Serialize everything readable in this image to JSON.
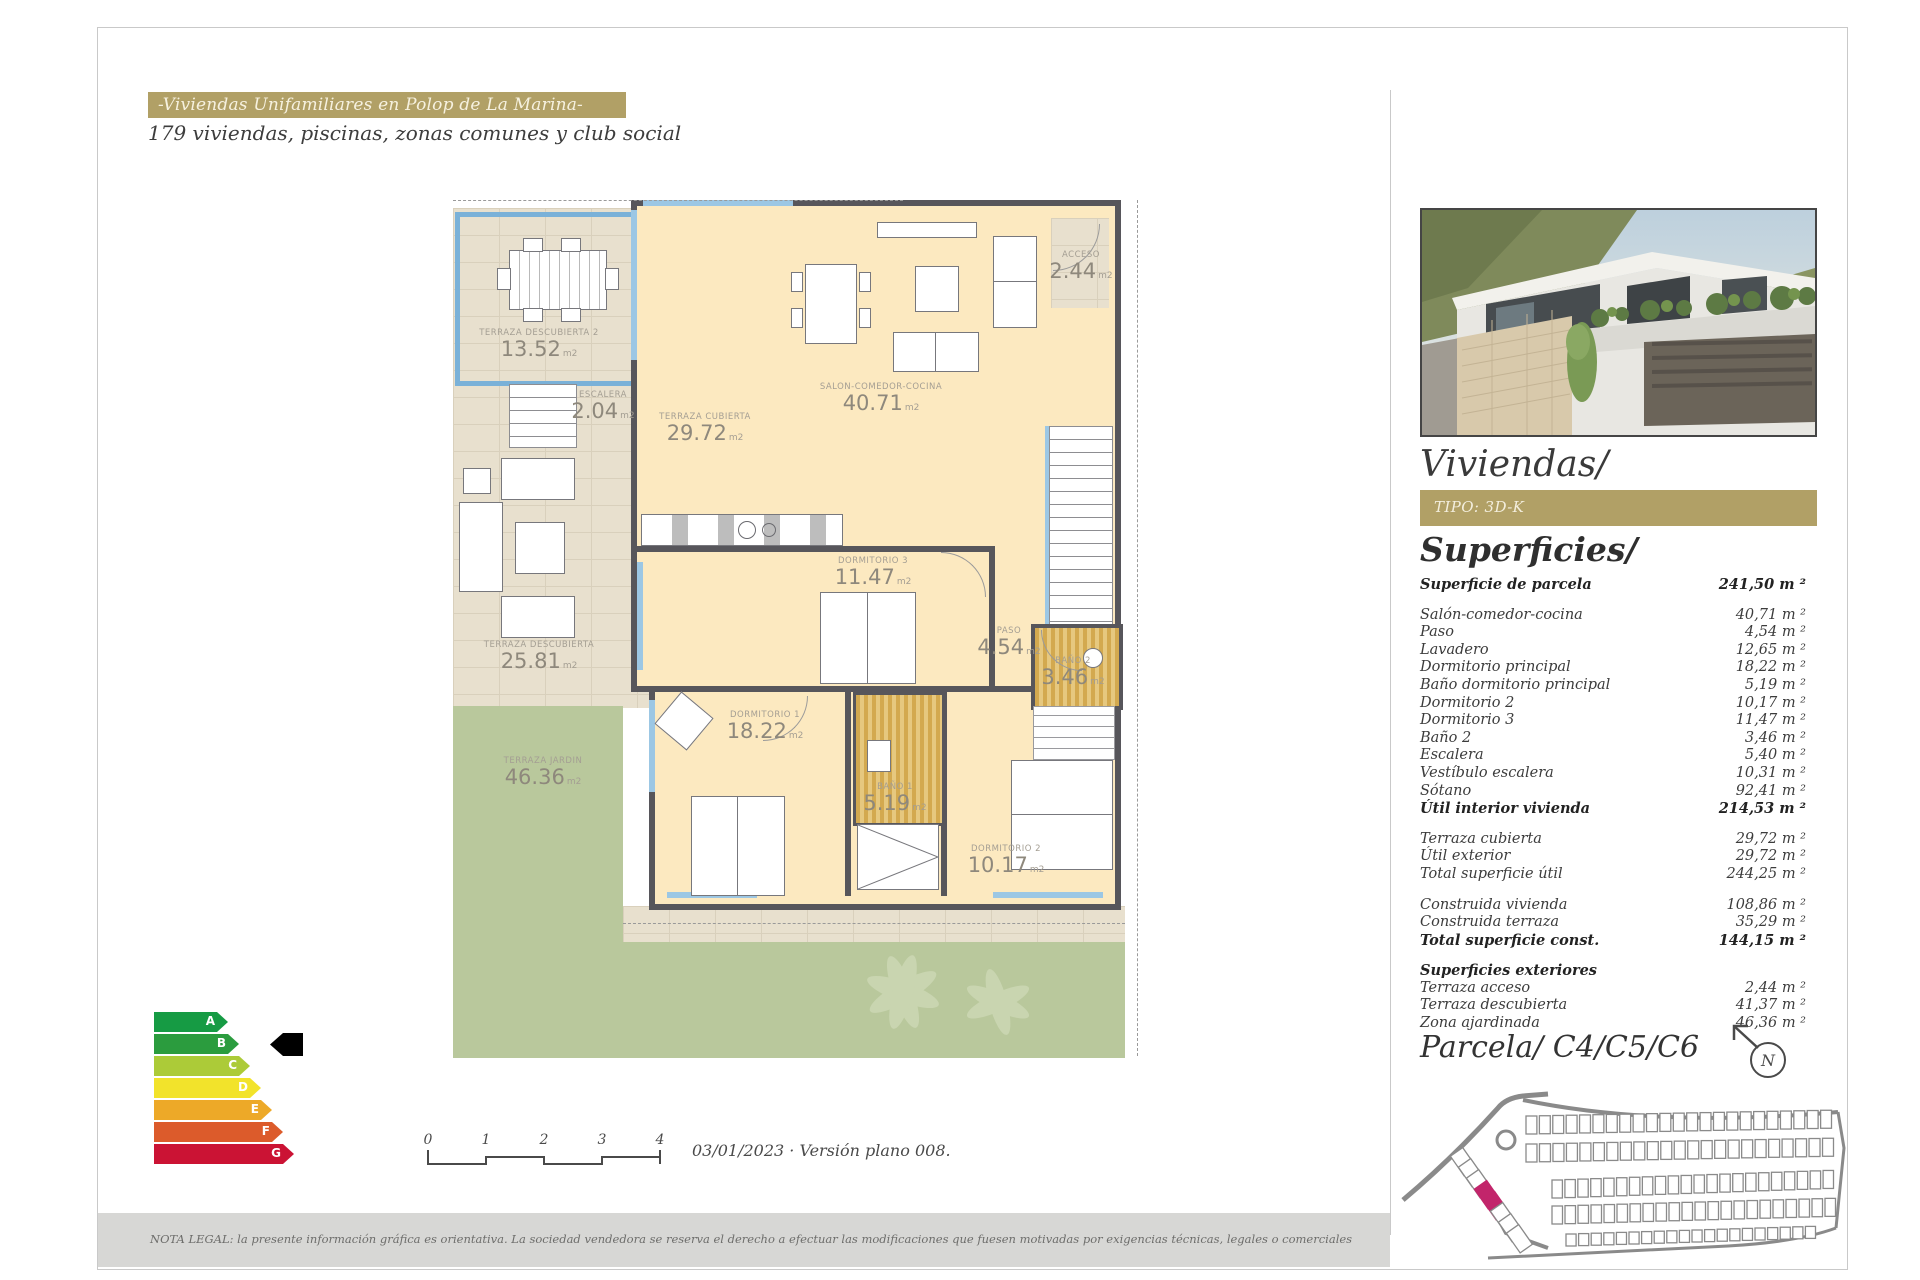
{
  "header": {
    "title": "-Viviendas Unifamiliares en Polop de La Marina-",
    "subtitle": "179 viviendas, piscinas, zonas comunes y club social"
  },
  "sidebar": {
    "viviendas_heading": "Viviendas/",
    "tipo_label": "TIPO: 3D-K",
    "superficies_heading": "Superficies/",
    "parcela_heading": "Parcela/ C4/C5/C6",
    "compass_letter": "N",
    "superficies": {
      "groups": [
        [
          {
            "label": "Superficie de parcela",
            "value": "241,50 m ²",
            "bold": true
          }
        ],
        [
          {
            "label": "Salón-comedor-cocina",
            "value": "40,71 m ²",
            "bold": false
          },
          {
            "label": "Paso",
            "value": "4,54 m ²",
            "bold": false
          },
          {
            "label": "Lavadero",
            "value": "12,65 m ²",
            "bold": false
          },
          {
            "label": "Dormitorio principal",
            "value": "18,22 m ²",
            "bold": false
          },
          {
            "label": "Baño dormitorio principal",
            "value": "5,19 m ²",
            "bold": false
          },
          {
            "label": "Dormitorio 2",
            "value": "10,17 m ²",
            "bold": false
          },
          {
            "label": "Dormitorio 3",
            "value": "11,47 m ²",
            "bold": false
          },
          {
            "label": "Baño 2",
            "value": "3,46 m ²",
            "bold": false
          },
          {
            "label": "Escalera",
            "value": "5,40 m ²",
            "bold": false
          },
          {
            "label": "Vestíbulo escalera",
            "value": "10,31 m ²",
            "bold": false
          },
          {
            "label": "Sótano",
            "value": "92,41 m ²",
            "bold": false
          },
          {
            "label": "Útil interior vivienda",
            "value": "214,53 m ²",
            "bold": true
          }
        ],
        [
          {
            "label": "Terraza cubierta",
            "value": "29,72 m ²",
            "bold": false
          },
          {
            "label": "Útil exterior",
            "value": "29,72 m ²",
            "bold": false
          },
          {
            "label": "Total superficie útil",
            "value": "244,25 m ²",
            "bold": false
          }
        ],
        [
          {
            "label": "Construida vivienda",
            "value": "108,86 m ²",
            "bold": false
          },
          {
            "label": "Construida terraza",
            "value": "35,29 m ²",
            "bold": false
          },
          {
            "label": "Total superficie const.",
            "value": "144,15 m ²",
            "bold": true
          }
        ],
        [
          {
            "label": "Superficies exteriores",
            "value": "",
            "bold": true
          },
          {
            "label": "Terraza acceso",
            "value": "2,44 m ²",
            "bold": false
          },
          {
            "label": "Terraza descubierta",
            "value": "41,37 m ²",
            "bold": false
          },
          {
            "label": "Zona ajardinada",
            "value": "46,36 m ²",
            "bold": false
          }
        ]
      ]
    }
  },
  "floorplan": {
    "unit": "m2",
    "rooms": [
      {
        "name": "TERRAZA DESCUBIERTA 2",
        "area": "13.52",
        "unit": "m2"
      },
      {
        "name": "ESCALERA",
        "area": "2.04",
        "unit": "m2"
      },
      {
        "name": "TERRAZA CUBIERTA",
        "area": "29.72",
        "unit": "m2"
      },
      {
        "name": "SALON-COMEDOR-COCINA",
        "area": "40.71",
        "unit": "m2"
      },
      {
        "name": "ACCESO",
        "area": "2.44",
        "unit": "m2"
      },
      {
        "name": "DORMITORIO 3",
        "area": "11.47",
        "unit": "m2"
      },
      {
        "name": "PASO",
        "area": "4.54",
        "unit": "m2"
      },
      {
        "name": "BAÑO 2",
        "area": "3.46",
        "unit": "m2"
      },
      {
        "name": "DORMITORIO 1",
        "area": "18.22",
        "unit": "m2"
      },
      {
        "name": "BAÑO 1",
        "area": "5.19",
        "unit": "m2"
      },
      {
        "name": "DORMITORIO 2",
        "area": "10.17",
        "unit": "m2"
      },
      {
        "name": "TERRAZA DESCUBIERTA",
        "area": "25.81",
        "unit": "m2"
      },
      {
        "name": "TERRAZA JARDIN",
        "area": "46.36",
        "unit": "m2"
      }
    ]
  },
  "energy": {
    "selected": "B",
    "grades": [
      {
        "letter": "A",
        "color": "#169b44"
      },
      {
        "letter": "B",
        "color": "#2b9c3e"
      },
      {
        "letter": "C",
        "color": "#accb38"
      },
      {
        "letter": "D",
        "color": "#f2e32b"
      },
      {
        "letter": "E",
        "color": "#eda928"
      },
      {
        "letter": "F",
        "color": "#dc5b2b"
      },
      {
        "letter": "G",
        "color": "#cb1334"
      }
    ]
  },
  "scalebar": {
    "ticks": [
      "0",
      "1",
      "2",
      "3",
      "4"
    ]
  },
  "footer": {
    "date_version": "03/01/2023 · Versión plano 008.",
    "legal": "NOTA LEGAL: la presente información gráfica es orientativa. La sociedad vendedora se reserva el derecho a efectuar las modificaciones que fuesen motivadas por exigencias técnicas, legales o comerciales"
  },
  "colors": {
    "accent_gold": "#b1a066",
    "plot_highlight": "#c2256b",
    "garden_green": "#b9c89c",
    "room_cream": "#fce9c0",
    "wall_gray": "#57565b",
    "bath_gold": "#d3a94f",
    "railing_blue": "#7ab1d8"
  }
}
